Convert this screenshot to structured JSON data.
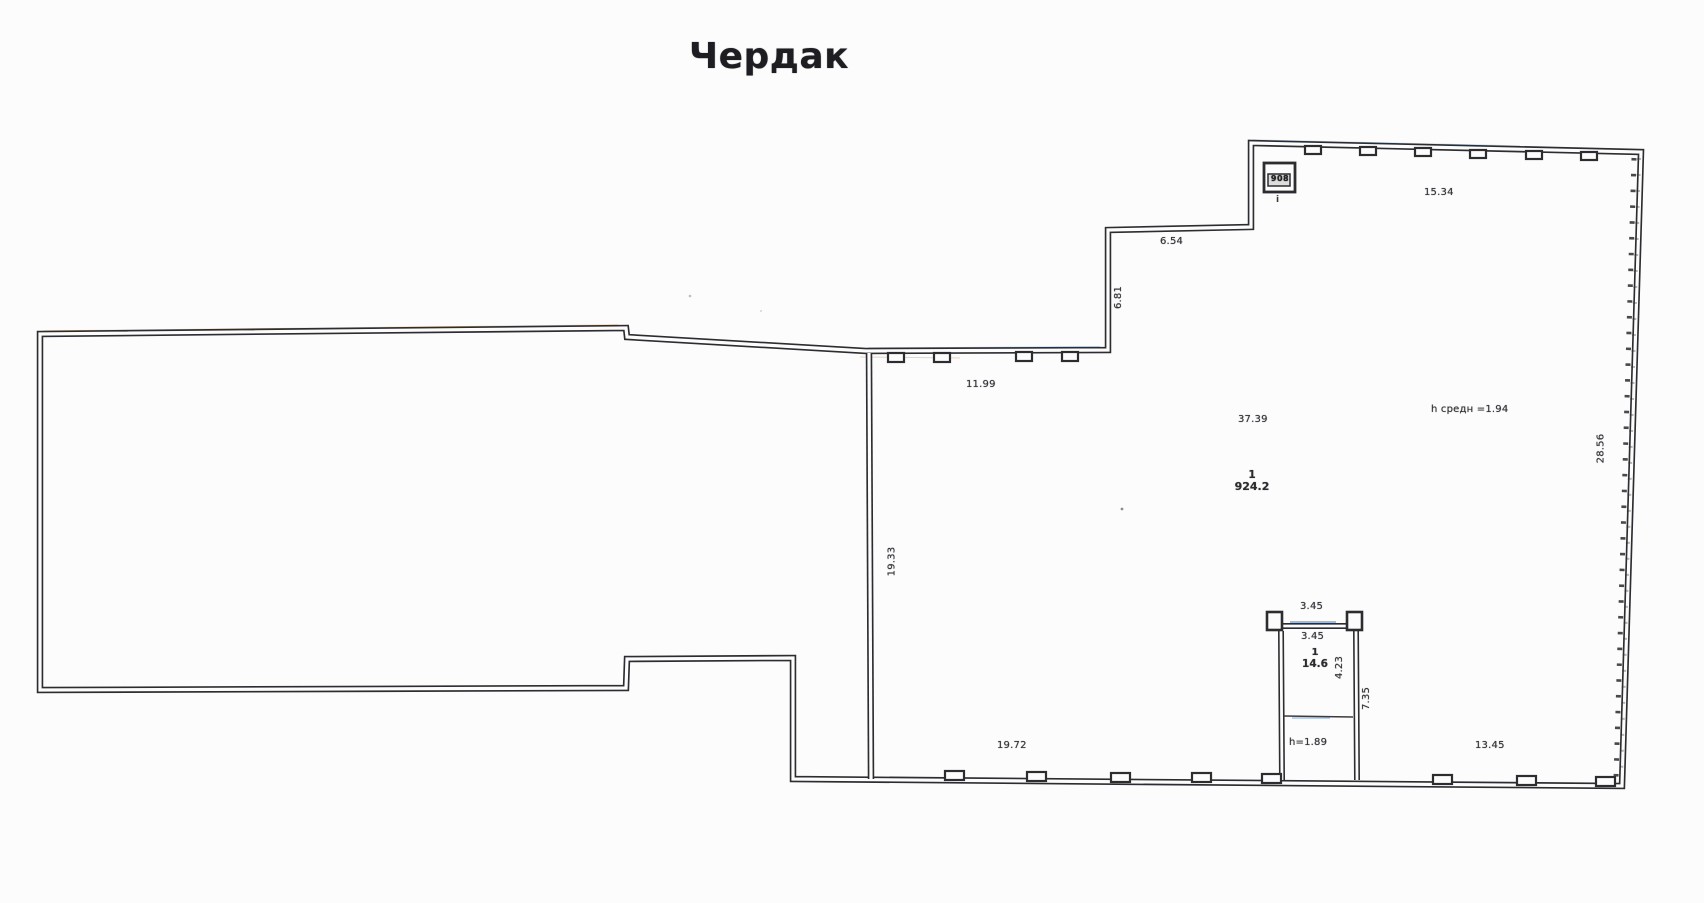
{
  "title": "Чердак",
  "colors": {
    "paper": "#fcfcfc",
    "ink": "#2d2d31",
    "scan_blue": "#4a90d9",
    "scan_orange": "#d9913f"
  },
  "plan": {
    "main_room": {
      "number": "1",
      "area": "924.2",
      "width": "37.39",
      "avg_height_note": "h средн =1.94"
    },
    "dimensions": {
      "top_right": "15.34",
      "step_top": "6.54",
      "step_side": "6.81",
      "ledge_top": "11.99",
      "right_side": "28.56",
      "left_inner": "19.33",
      "bottom_left": "19.72",
      "bottom_right": "13.45"
    },
    "booth": {
      "number": "1",
      "area": "14.6",
      "width_outer": "3.45",
      "width_inner": "3.45",
      "depth": "4.23",
      "depth_total": "7.35",
      "height_note": "h=1.89"
    },
    "stamp": {
      "code": "908",
      "mark": "i"
    }
  }
}
